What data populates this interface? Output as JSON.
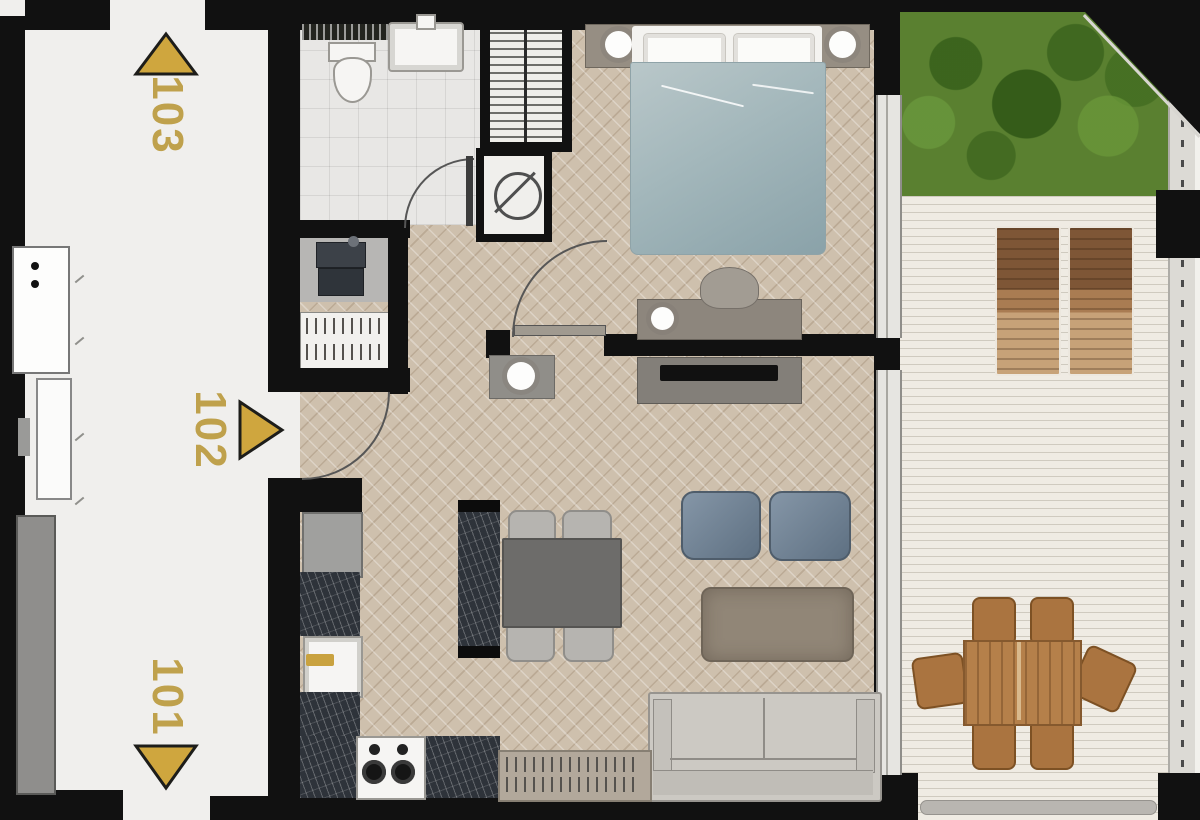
{
  "units": [
    {
      "label": "103",
      "arrow": "up"
    },
    {
      "label": "102",
      "arrow": "right"
    },
    {
      "label": "101",
      "arrow": "down"
    }
  ],
  "palette": {
    "wall": "#111111",
    "corridor_floor": "#f0efed",
    "parquet_floor": "#cec0ad",
    "bathroom_tile": "#e8e7e5",
    "deck": "#efebe3",
    "grass": "#5a8030",
    "gold_accent": "#c9a23f",
    "label_gold": "#bfa14c",
    "duvet_blue": "#a3b7bb",
    "kitchen_marble": "#2e333a",
    "outdoor_wood": "#b5804a"
  }
}
